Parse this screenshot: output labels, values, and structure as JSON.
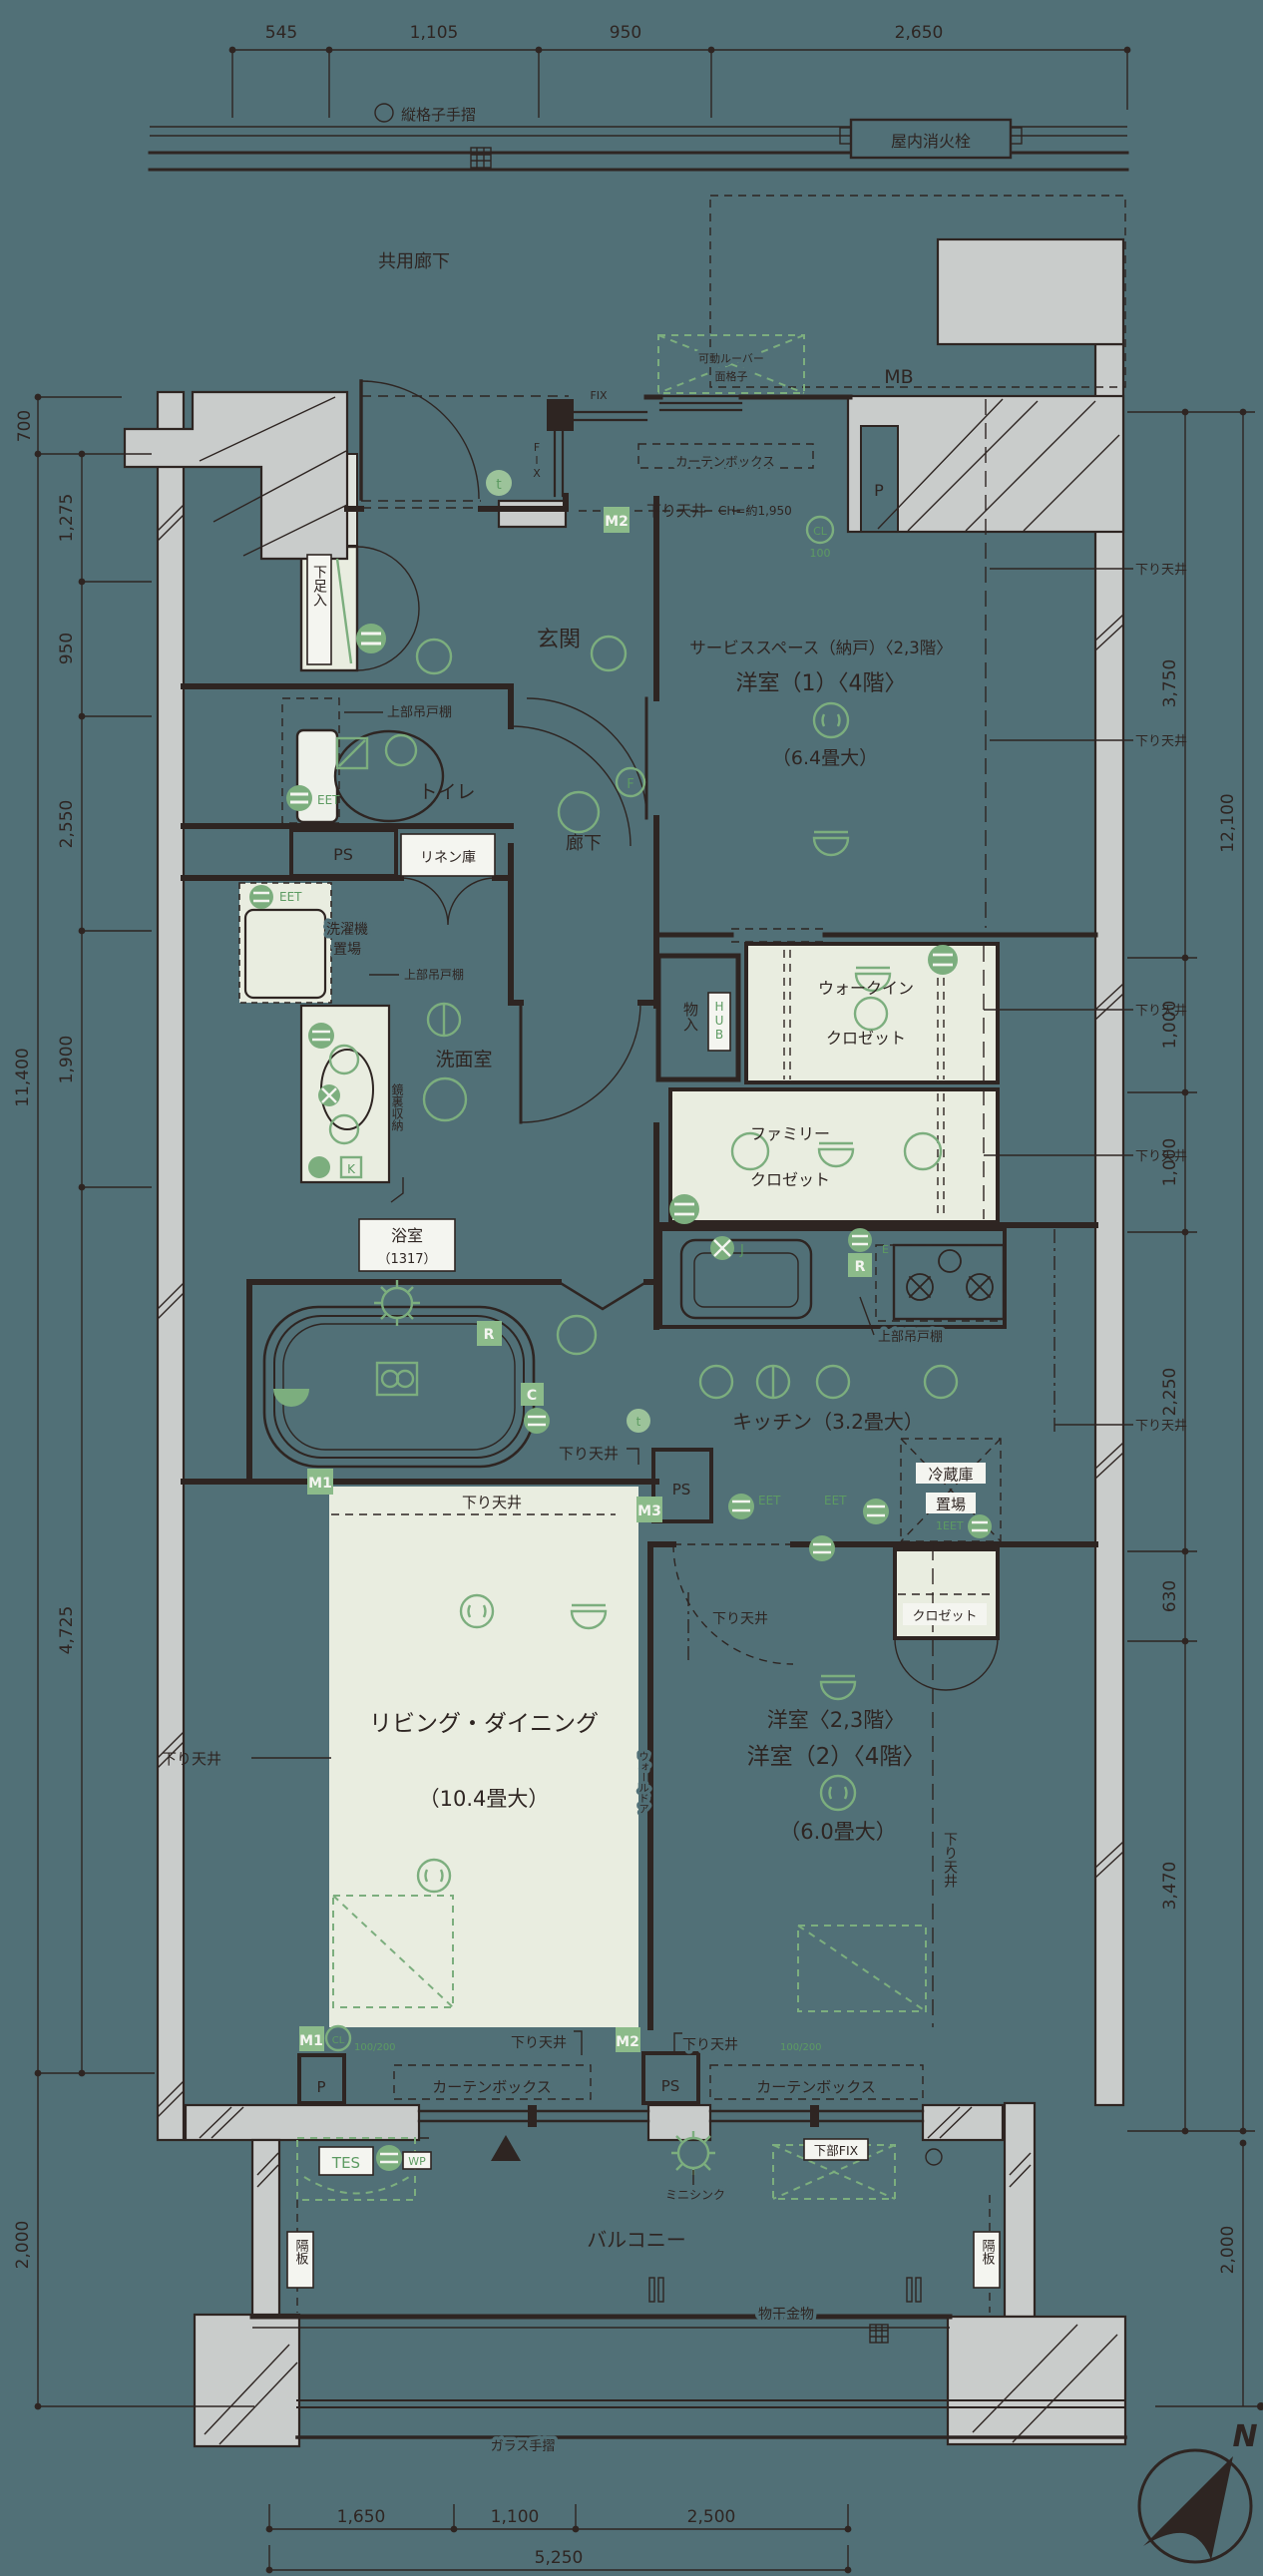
{
  "colors": {
    "background": "#517077",
    "wall": "#2e2522",
    "concrete": "#c9cccb",
    "room_fill": "#e9ede0",
    "annotation_green": "#7cae7e",
    "label_green_box": "#8cbb8a",
    "white": "#f4f5f0"
  },
  "common": {
    "sagari_tenjo": "下り天井",
    "curtain_box": "カーテンボックス",
    "ps": "PS",
    "p": "P",
    "fix": "FIX",
    "eet": "EET",
    "joubu_tsuridana": "上部吊戸棚",
    "kakuita": "隔板"
  },
  "top": {
    "dims": [
      "545",
      "1,105",
      "950",
      "2,650"
    ],
    "tategoshi_tesuri": "縦格子手摺",
    "fire_hydrant": "屋内消火栓",
    "kyoyo_roka": "共用廊下",
    "mb": "MB",
    "louver_l1": "可動ルーバー",
    "louver_l2": "面格子",
    "ch_note": "CH=約1,950"
  },
  "rooms": {
    "genkan": "玄関",
    "getabako": "下足入",
    "toilet": "トイレ",
    "linen": "リネン庫",
    "hall": "廊下",
    "washer_l1": "洗濯機",
    "washer_l2": "置場",
    "senmenshitsu": "洗面室",
    "kagamiura": "鏡裏収納",
    "bath": "浴室",
    "bath_size": "（1317）",
    "service_l1": "サービススペース（納戸）〈2,3階〉",
    "service_l2": "洋室（1）〈4階〉",
    "service_size": "（6.4畳大）",
    "monoire": "物入",
    "wic_l1": "ウォークイン",
    "wic_l2": "クロゼット",
    "family_l1": "ファミリー",
    "family_l2": "クロゼット",
    "kitchen": "キッチン（3.2畳大）",
    "reizoko_l1": "冷蔵庫",
    "reizoko_l2": "置場",
    "living": "リビング・ダイニング",
    "living_size": "（10.4畳大）",
    "wall_door": "ウォールドア",
    "yoshitsu2_l1": "洋室〈2,3階〉",
    "yoshitsu2_l2": "洋室（2）〈4階〉",
    "yoshitsu2_size": "（6.0畳大）",
    "closet": "クロゼット",
    "balcony": "バルコニー",
    "mini_sink": "ミニシンク",
    "kabu_fix": "下部FIX",
    "monohoshi": "物干金物",
    "glass_tesuri": "ガラス手摺"
  },
  "marks": {
    "m1": "M1",
    "m2": "M2",
    "m3": "M3",
    "cl": "CL",
    "cl_100": "100",
    "cl_100_200": "100/200",
    "tes": "TES",
    "wp": "WP",
    "hub": "HUB",
    "f": "F",
    "t": "t",
    "e": "E",
    "j": "J",
    "r": "R",
    "c": "C",
    "k": "K",
    "eet1": "1EET",
    "north": "N"
  },
  "dims": {
    "left": [
      "700",
      "1,275",
      "950",
      "2,550",
      "1,900",
      "4,725"
    ],
    "left_total": "11,400",
    "left_balcony": "2,000",
    "right": [
      "3,750",
      "1,000",
      "1,000",
      "2,250",
      "630",
      "3,470"
    ],
    "right_total": "12,100",
    "right_balcony": "2,000",
    "bottom": [
      "1,650",
      "1,100",
      "2,500"
    ],
    "bottom_total": "5,250"
  }
}
